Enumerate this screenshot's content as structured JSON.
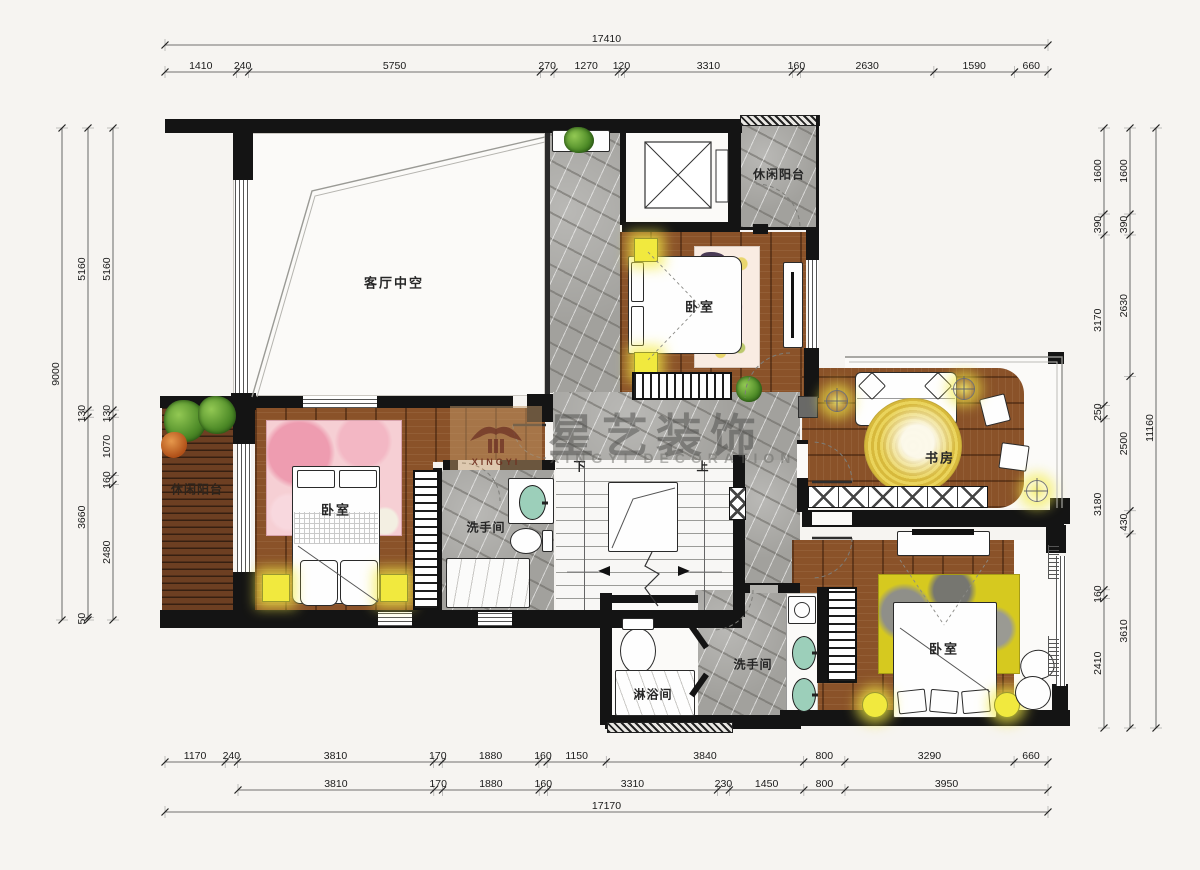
{
  "watermark": {
    "logo_text": "XINGYI",
    "brand_cn": "星艺装饰",
    "brand_en": "XINGYI DECORATION"
  },
  "rooms": {
    "living_void": "客厅中空",
    "balcony_top_right": "休闲阳台",
    "balcony_left": "休闲阳台",
    "bedroom_top": "卧室",
    "bedroom_left": "卧室",
    "bedroom_bottom": "卧室",
    "study": "书房",
    "bathroom_mid": "洗手间",
    "bathroom_bottom": "洗手间",
    "shower_room": "淋浴间",
    "stairs_down": "下",
    "stairs_up": "上"
  },
  "dimensions": {
    "top": {
      "total": "17410",
      "segments": [
        "1410",
        "240",
        "5750",
        "270",
        "1270",
        "120",
        "3310",
        "160",
        "2630",
        "1590",
        "660"
      ]
    },
    "left": {
      "total": "9000",
      "chain_mid": [
        "5160",
        "130",
        "3660",
        "50"
      ],
      "chain_inner": [
        "5160",
        "130",
        "1070",
        "160",
        "2480"
      ]
    },
    "right": {
      "total": "11160",
      "chain_inner": [
        "1600",
        "390",
        "3170",
        "250",
        "3180",
        "160",
        "2410"
      ],
      "chain_mid": [
        "1600",
        "390",
        "2630",
        "2500",
        "430",
        "3610"
      ]
    },
    "bottom": {
      "total": "17170",
      "row1": [
        "1170",
        "240",
        "3810",
        "170",
        "1880",
        "160",
        "1150",
        "3840",
        "800",
        "3290",
        "660"
      ],
      "row2": [
        "3810",
        "170",
        "1880",
        "160",
        "3310",
        "230",
        "1450",
        "800",
        "3950"
      ]
    }
  },
  "colors": {
    "wall": "#141414",
    "wood_floor": "#8a5229",
    "marble_floor": "#a2a19d",
    "accent_light": "#f1e93e",
    "rug_pink": "#f6cfd4",
    "rug_yellow": "#d6c91f",
    "sink_green": "#9ccfba"
  }
}
